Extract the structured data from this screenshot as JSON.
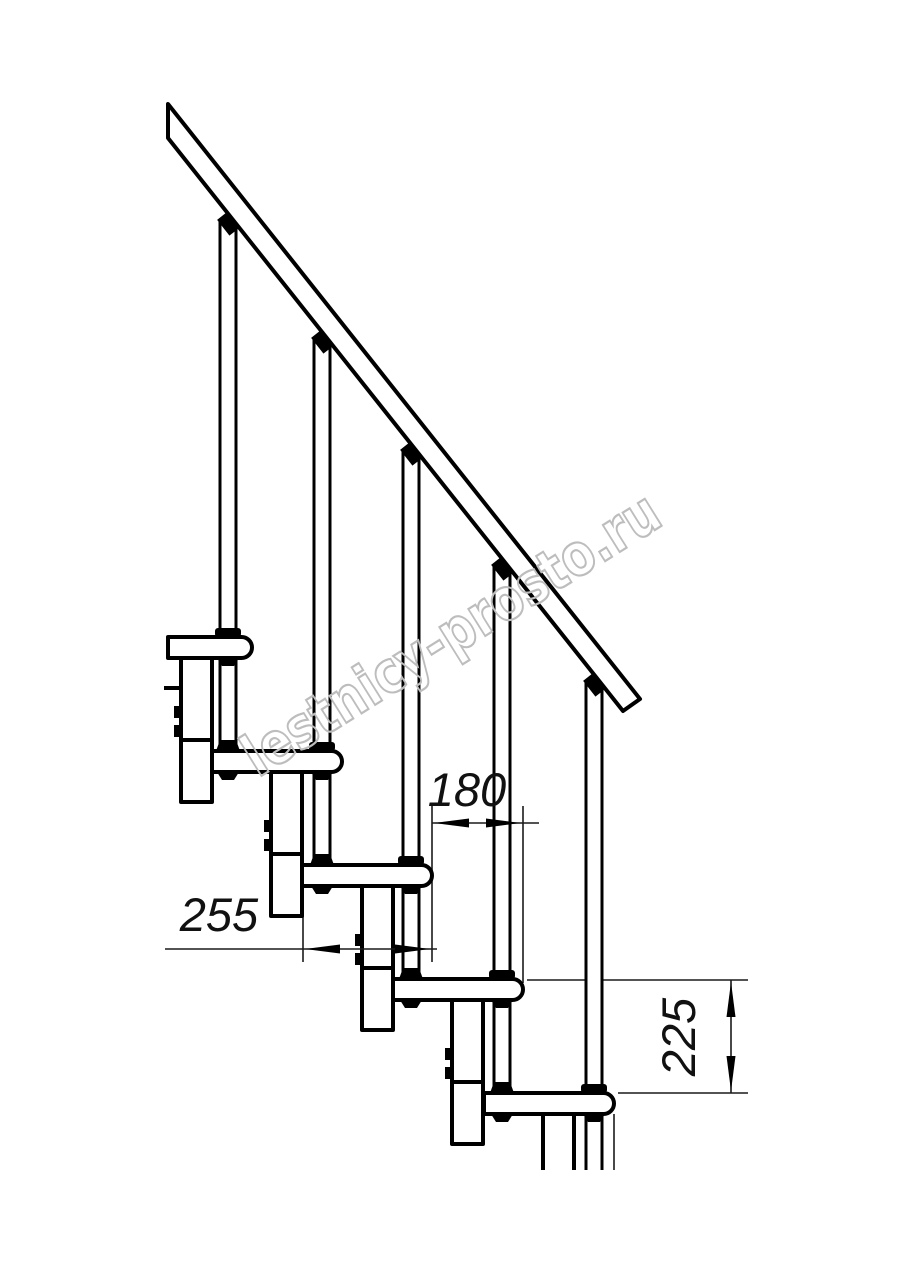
{
  "drawing": {
    "subject": "modular staircase side elevation",
    "visible_steps": 5,
    "visible_balusters": 5,
    "colors": {
      "background": "#ffffff",
      "line": "#000000",
      "dimension_line": "#1a1a1a",
      "watermark": "#bdbdbd"
    }
  },
  "dimensions": {
    "step_run": {
      "label": "180",
      "orientation": "horizontal"
    },
    "tread_depth": {
      "label": "255",
      "orientation": "horizontal"
    },
    "step_rise": {
      "label": "225",
      "orientation": "vertical"
    }
  },
  "watermark": {
    "text": "lestnicy-prosto.ru"
  }
}
